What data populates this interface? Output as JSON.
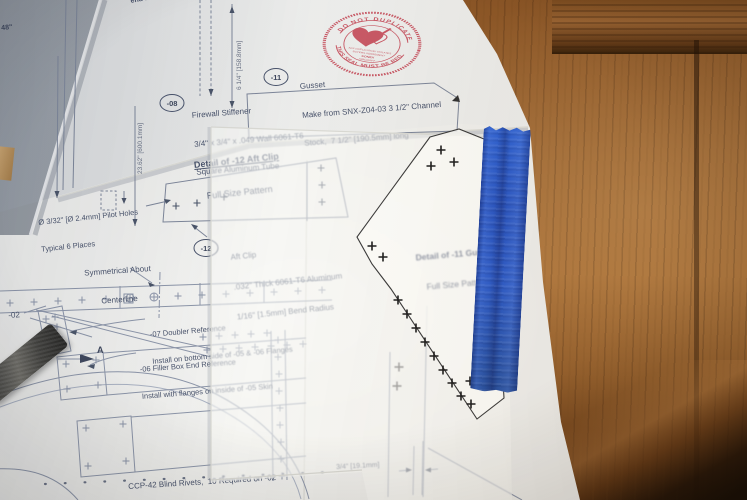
{
  "stamp": {
    "ring_top": "DO NOT DUPLICATE",
    "ring_bottom": "THIS SEAL MUST BE RED",
    "center": [
      "ANY DUPLICATION VIOLATES",
      "BUYERS AGREEMENT",
      "SONEX",
      "AIRCRAFT"
    ],
    "color": "#c2404f"
  },
  "callouts": {
    "firewall": {
      "id": "-08",
      "line1": "Firewall Stiffener",
      "line2": "3/4\" x 3/4\" x .049 Wall 6061-T6",
      "line3": "Square Aluminum Tube"
    },
    "gusset": {
      "id": "-11",
      "line1": "Gusset",
      "line2": "Make from SNX-Z04-03 3 1/2\" Channel",
      "line3": "Stock,  7 1/2\" [190.5mm] long"
    },
    "aft_clip": {
      "id": "-12",
      "line1": "Aft Clip",
      "line2": ".032\" Thick 6061-T6 Aluminum",
      "line3": "1/16\" [1.5mm] Bend Radius"
    }
  },
  "headings": {
    "detail12_line1": "Detail of -12 Aft Clip",
    "detail12_line2": "Full Size Pattern",
    "detail11_line1": "Detail of -11 Gusset",
    "detail11_line2": "Full Size Pattern"
  },
  "notes": {
    "partial_bend_radius": "end Radius",
    "partial_48": "48\"",
    "pilot_line1": "Ø 3/32\" [Ø 2.4mm] Pilot Holes",
    "pilot_line2": "Typical 6 Places",
    "sym_line1": "Symmetrical About",
    "sym_line2": "Centerline",
    "doubler_line1": "-07 Doubler Reference",
    "doubler_line2": "Install on bottom side of -05 & -06 Flanges",
    "filler_line1": "-06 Filler Box End Reference",
    "filler_line2": "Install with flanges on inside of -05 Skin",
    "part_02": "-02",
    "section_a": "A",
    "rivet_note": "CCP-42 Blind Rivets,  10 Required on -02"
  },
  "dimensions": {
    "tube_height": "6 1/4\" [158.8mm]",
    "panel_width": "23.62\" [600.1mm]",
    "rivet_edge": "3/4\" [19.1mm]"
  },
  "materials": {
    "tape_color": "#2b57cb",
    "wood_color": "#9a6130",
    "paper_color": "#efefec",
    "ink_color": "#4a5468"
  }
}
